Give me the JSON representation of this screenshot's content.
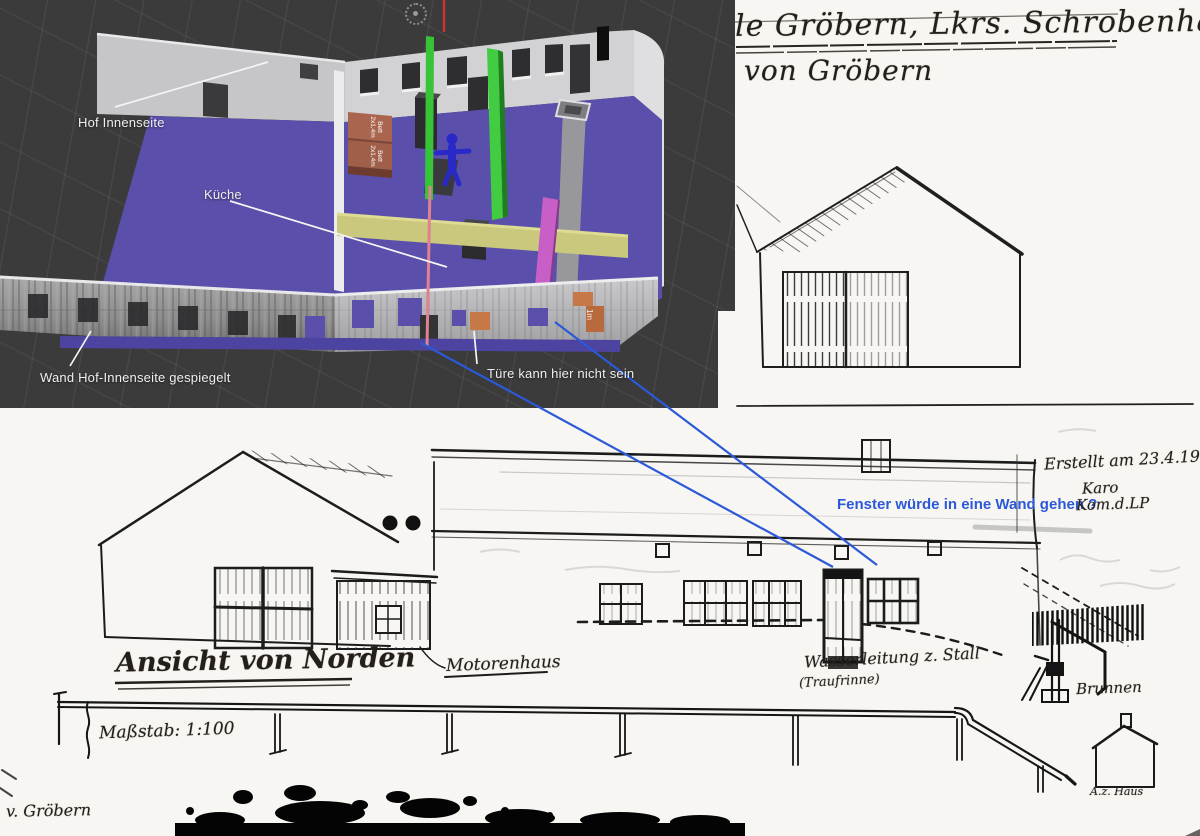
{
  "viewport": {
    "labels": {
      "hof": "Hof Innenseite",
      "kueche": "Küche",
      "wand": "Wand Hof-Innenseite gespiegelt",
      "tuere": "Türe kann hier nicht sein"
    },
    "beds": {
      "line1": "Bett",
      "line2": "2x1,4m"
    },
    "scale_marker": "1m",
    "colors": {
      "background": "#3b3b3b",
      "floor": "#5a50ab",
      "green_wall": "#3ec43e",
      "yellow_wall": "#c9c87c",
      "magenta_wall": "#c75fc7",
      "bed": "#a9654e",
      "figure": "#2929c8"
    }
  },
  "blue_annotation": {
    "fenster": "Fenster würde in eine Wand gehen ?",
    "color": "#2b59d8"
  },
  "scan_top": {
    "title_line1": "le Gröbern, Lkrs. Schrobenhausen",
    "title_line2": "von Gröbern"
  },
  "scan_bottom": {
    "ansicht": "Ansicht von Norden",
    "motorenhaus": "Motorenhaus",
    "wasserleitung_line1": "Wasserleitung z. Stall",
    "wasserleitung_line2": "(Traufrinne)",
    "brunnen": "Brunnen",
    "massstab": "Maßstab: 1:100",
    "erstellt": "Erstellt am 23.4.1954",
    "sign_line1": "Karo",
    "sign_line2": "Kom.d.LP",
    "corner": "v. Gröbern",
    "small_house_label": "A.z. Haus"
  }
}
